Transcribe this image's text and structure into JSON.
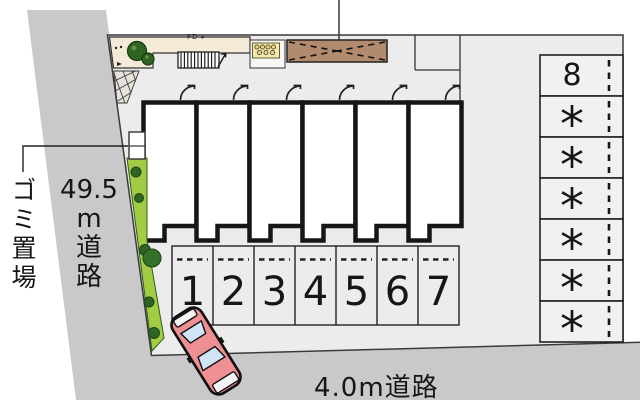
{
  "plan": {
    "garbage_label": "ゴミ置場",
    "left_road_label": [
      "49.5",
      "m",
      "道",
      "路"
    ],
    "bottom_road_label": "4.0m道路",
    "walkway_mark": "FD ▸",
    "parking_numbers": [
      "1",
      "2",
      "3",
      "4",
      "5",
      "6",
      "7"
    ],
    "right_stalls": [
      "8",
      "*",
      "*",
      "*",
      "*",
      "*",
      "*"
    ],
    "colors": {
      "road": "#c9c9cb",
      "plot": "#ececec",
      "walkway": "#f4ead7",
      "cycle_port": "#b28a6d",
      "planter": "#f1e8b4",
      "hedge": "#a3cc45",
      "bush": "#2f6424",
      "car_body": "#ee8f93",
      "car_glass": "#cfe4f7",
      "line": "#1a1a1a"
    }
  }
}
